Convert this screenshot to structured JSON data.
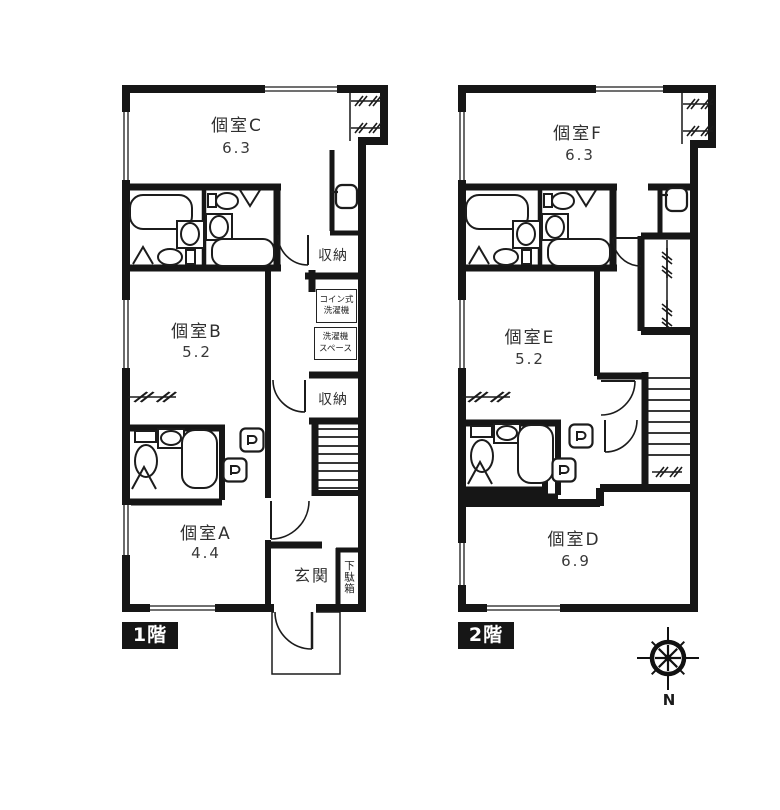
{
  "floor1": {
    "label": "1階",
    "room_c": {
      "name": "個室C",
      "area": "6.3"
    },
    "room_b": {
      "name": "個室B",
      "area": "5.2"
    },
    "room_a": {
      "name": "個室A",
      "area": "4.4"
    },
    "storage_upper": "収納",
    "storage_lower": "収納",
    "coin_washer": {
      "line1": "コイン式",
      "line2": "洗濯機"
    },
    "washer_space": {
      "line1": "洗濯機",
      "line2": "スペース"
    },
    "entrance": "玄関",
    "shoe_cabinet": "下駄箱"
  },
  "floor2": {
    "label": "2階",
    "room_f": {
      "name": "個室F",
      "area": "6.3"
    },
    "room_e": {
      "name": "個室E",
      "area": "5.2"
    },
    "room_d": {
      "name": "個室D",
      "area": "6.9"
    }
  },
  "compass": {
    "north": "N"
  },
  "colors": {
    "wall": "#161616",
    "background": "#ffffff",
    "text": "#2f2f2f"
  }
}
